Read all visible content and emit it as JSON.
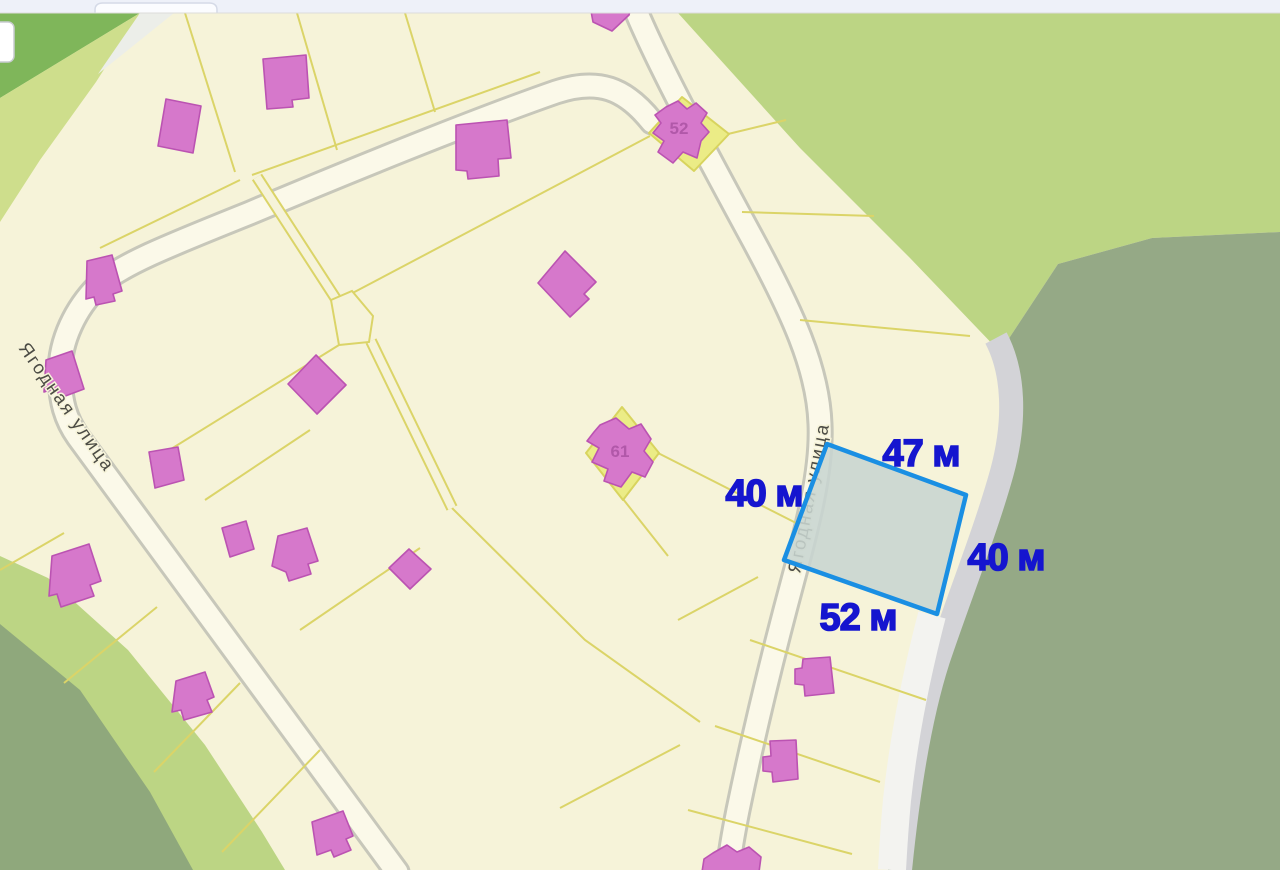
{
  "browser_bar": {
    "background": "#eef1f9",
    "tab": {
      "label": ""
    }
  },
  "map": {
    "streets": [
      {
        "name": "Ягодная улица",
        "position": "west"
      },
      {
        "name": "Ягодная улица",
        "position": "east"
      }
    ],
    "buildings": [
      {
        "number": "52"
      },
      {
        "number": "61"
      }
    ],
    "plot": {
      "fill": "#c8d5d0",
      "stroke": "#1a8fe3",
      "label_color": "#1515cf",
      "sides": [
        {
          "side": "top",
          "label": "47 м"
        },
        {
          "side": "left",
          "label": "40 м"
        },
        {
          "side": "right",
          "label": "40 м"
        },
        {
          "side": "bottom",
          "label": "52 м"
        }
      ]
    },
    "colors": {
      "parcel_background": "#f6f3d9",
      "parcel_line": "#dbd468",
      "street_fill": "#fbf9e9",
      "building_fill": "#d678cb",
      "green_northwest": "#7fb65a",
      "green_light": "#bcd584",
      "green_dark_east": "#95a986",
      "green_dark_southwest": "#8fa87c",
      "highlighted_parcel": "#ebec86",
      "roadside_strip_gray": "#d3d3d7",
      "roadside_strip_white": "#f3f3f0"
    }
  }
}
